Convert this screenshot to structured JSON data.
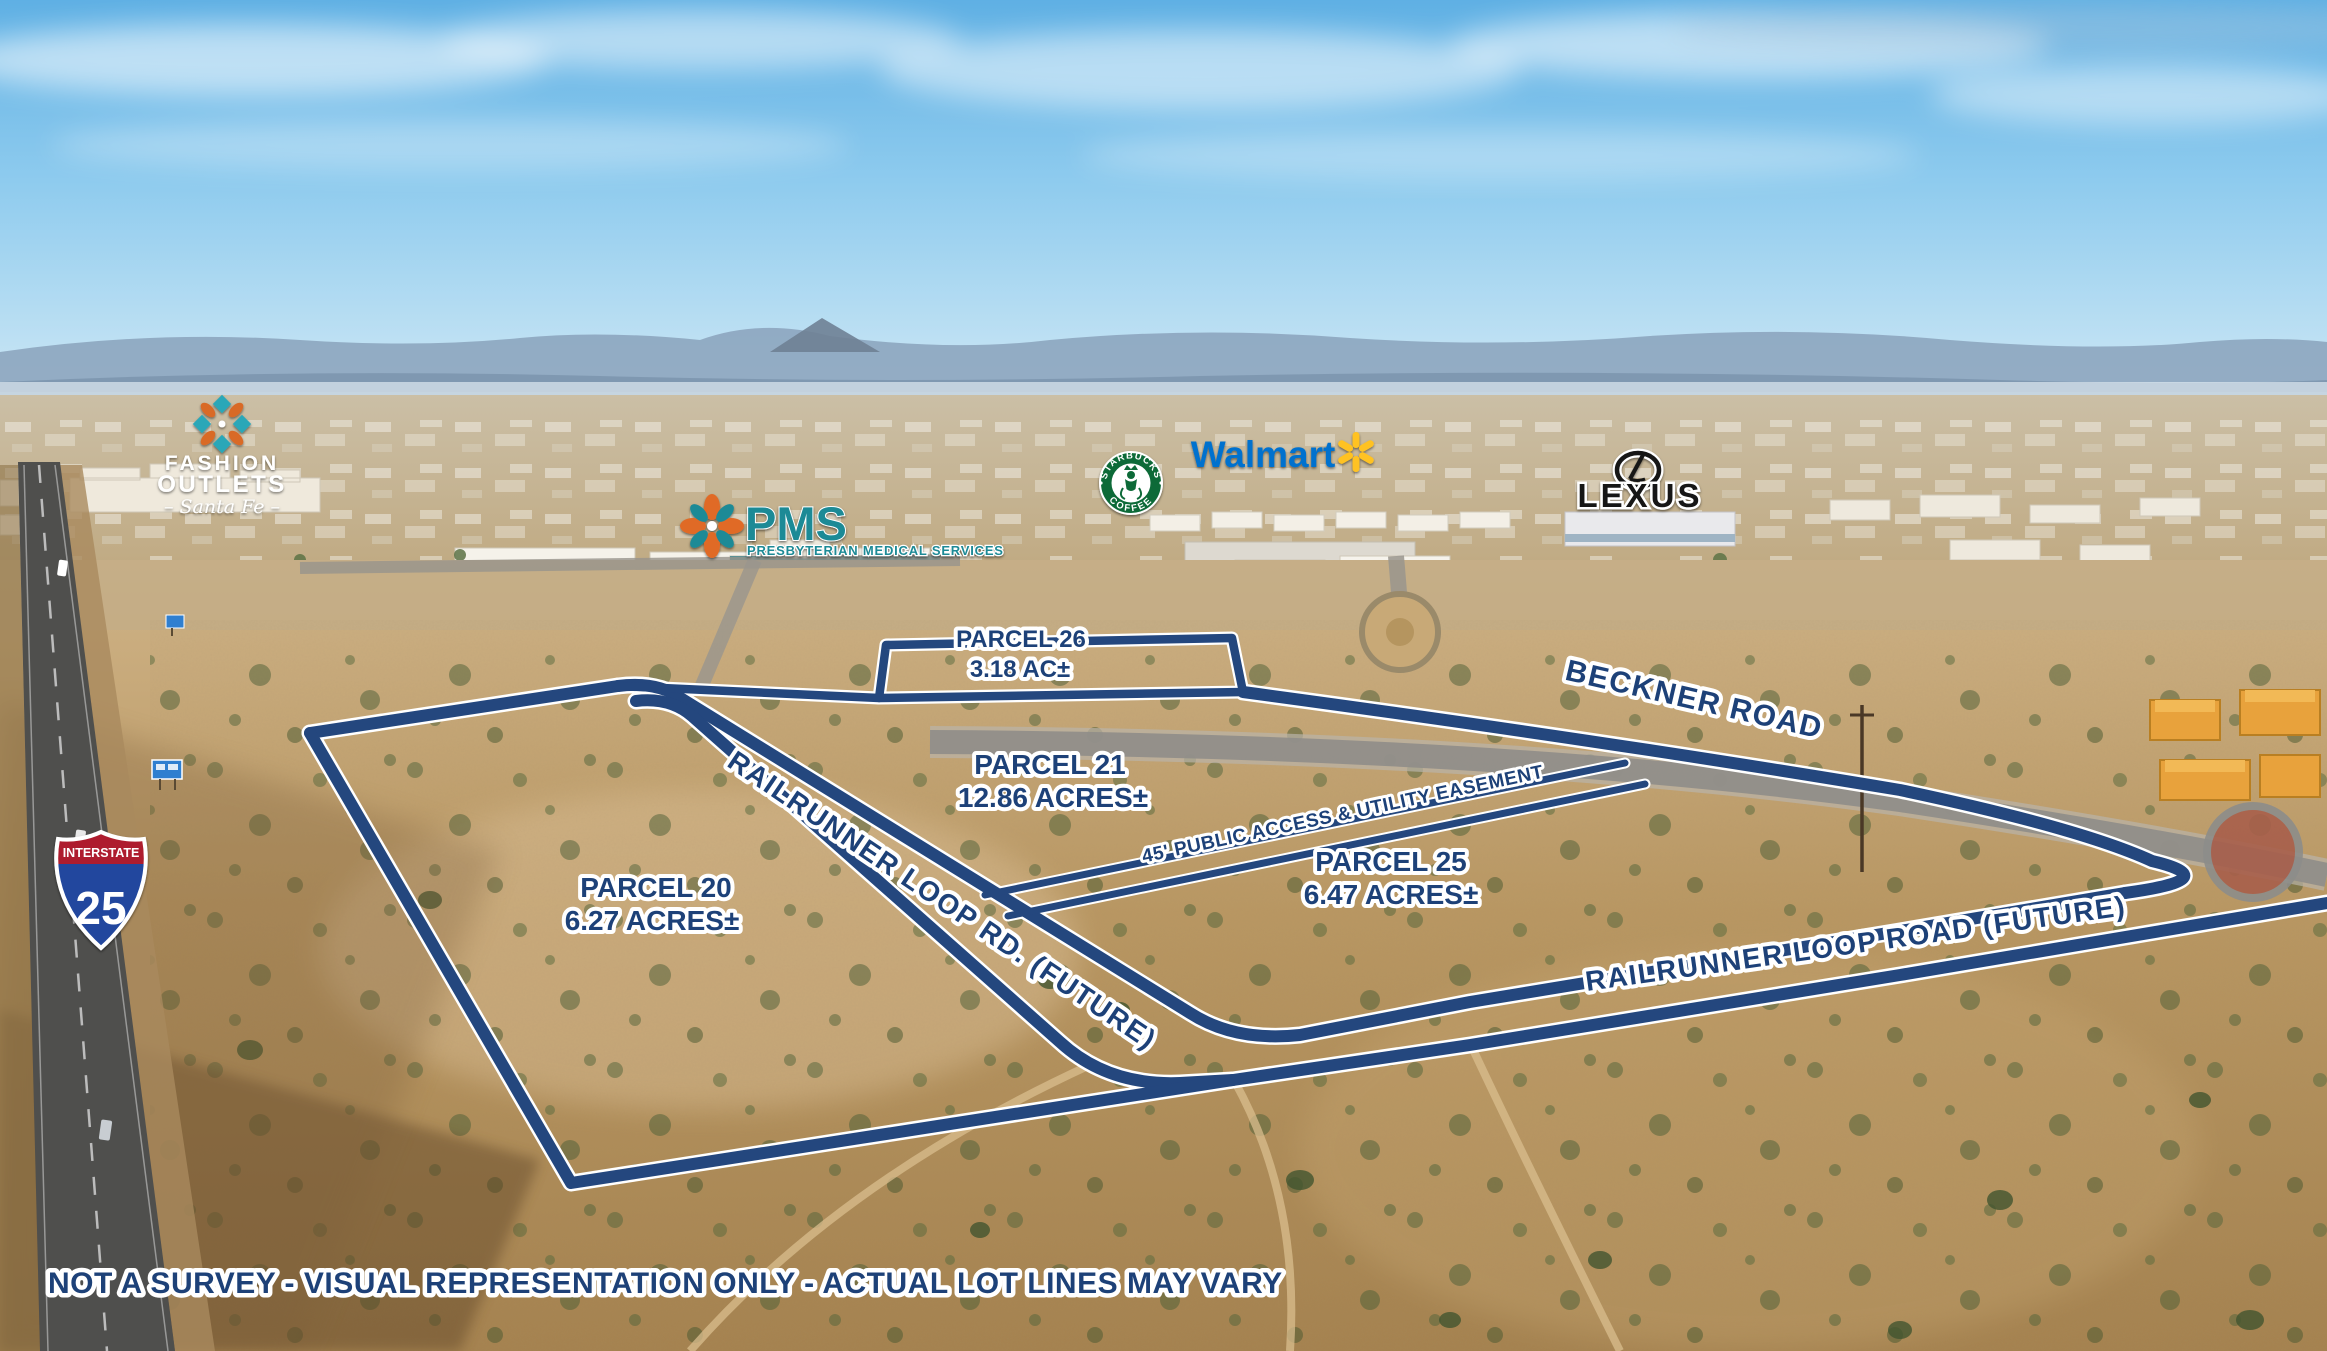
{
  "disclaimer": "NOT A SURVEY - VISUAL REPRESENTATION ONLY - ACTUAL LOT LINES MAY VARY",
  "parcels": {
    "p20": {
      "name": "PARCEL 20",
      "area": "6.27 ACRES±"
    },
    "p21": {
      "name": "PARCEL 21",
      "area": "12.86 ACRES±"
    },
    "p25": {
      "name": "PARCEL 25",
      "area": "6.47 ACRES±"
    },
    "p26": {
      "name": "PARCEL 26",
      "area": "3.18 AC±"
    }
  },
  "roads": {
    "beckner": {
      "label": "BECKNER ROAD"
    },
    "railrunner_sw": {
      "label": "RAILRUNNER LOOP RD. (FUTURE)"
    },
    "railrunner_se": {
      "label": "RAILRUNNER LOOP ROAD (FUTURE)"
    }
  },
  "easement": {
    "label": "45' PUBLIC ACCESS & UTILITY EASEMENT"
  },
  "landmarks": {
    "interstate": {
      "shield_top": "INTERSTATE",
      "shield_number": "25"
    },
    "fashion_outlets": {
      "line1": "FASHION",
      "line2": "OUTLETS",
      "line3": "– Santa Fe –"
    },
    "pms": {
      "name": "PMS",
      "tagline": "PRESBYTERIAN MEDICAL SERVICES"
    },
    "starbucks": {
      "ring_top": "STARBUCKS",
      "ring_bottom": "COFFEE"
    },
    "walmart": {
      "label": "Walmart"
    },
    "lexus": {
      "label": "LEXUS"
    }
  },
  "colors": {
    "overlay_navy": "#24477e",
    "label_navy": "#1d4178",
    "walmart_blue": "#0071ce",
    "walmart_spark": "#ffc220",
    "starbucks_green": "#0e6b39",
    "pms_teal": "#1f8a96",
    "pms_orange": "#e06a25",
    "outlets_teal": "#2aa7b8",
    "outlets_orange": "#d96a28",
    "shield_red": "#ae1f2d",
    "shield_blue": "#20479e",
    "lexus_black": "#141414"
  }
}
